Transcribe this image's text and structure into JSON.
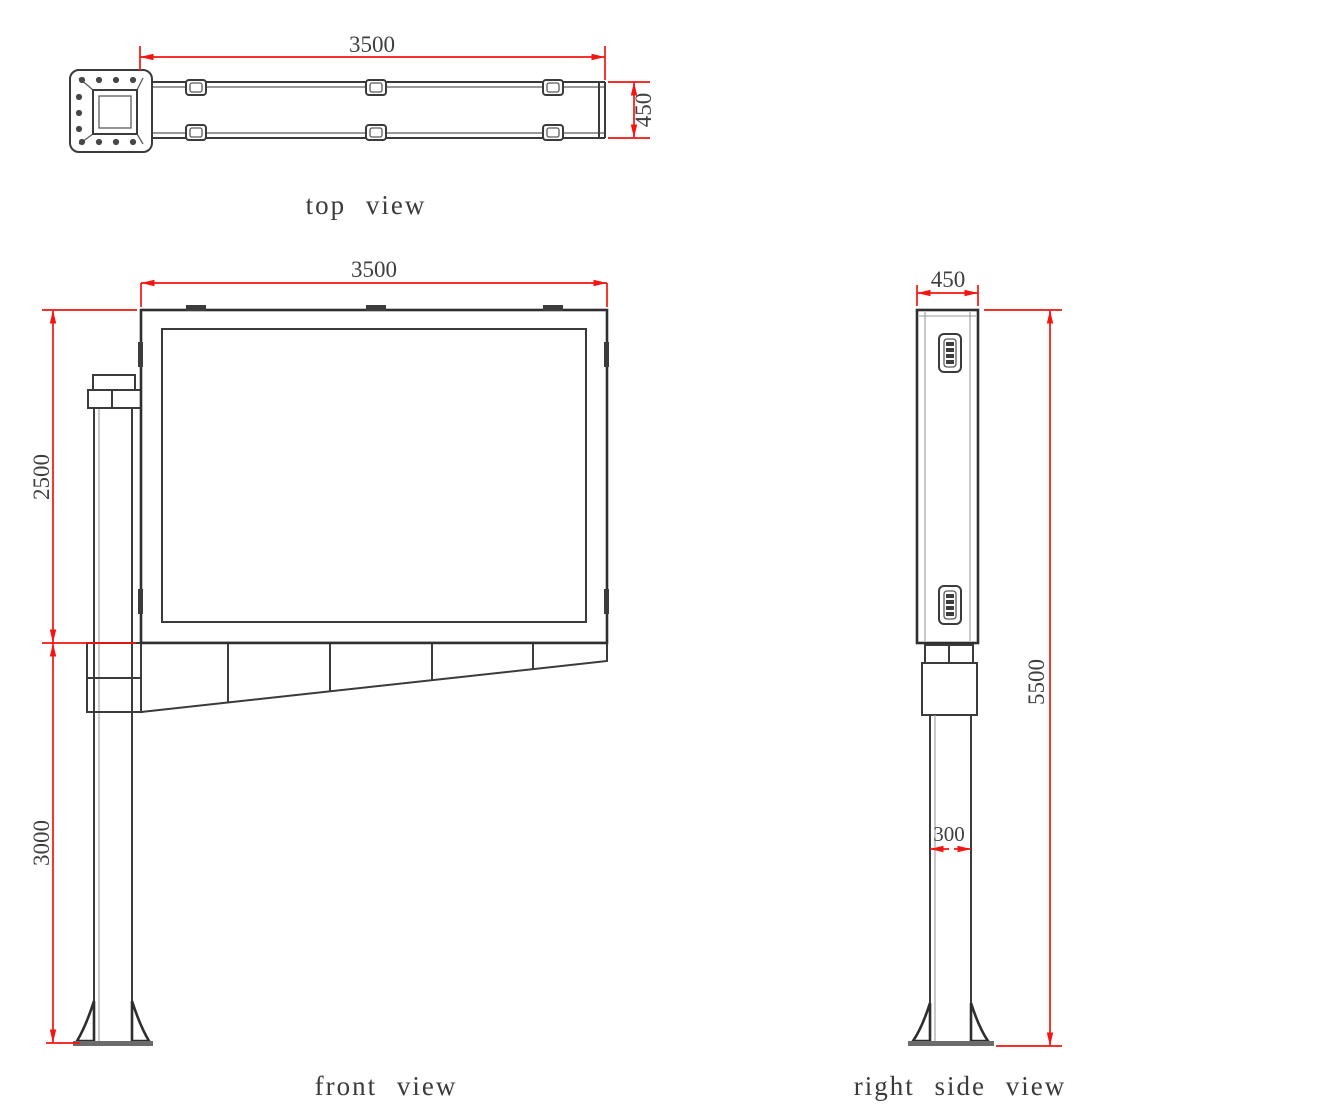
{
  "colors": {
    "dimension_color": "#f41410",
    "line_color": "#3b3b3b",
    "background": "#ffffff"
  },
  "views": {
    "top": {
      "label": "top view",
      "dimensions": {
        "width": "3500",
        "depth": "450"
      }
    },
    "front": {
      "label": "front view",
      "dimensions": {
        "width": "3500",
        "board_height": "2500",
        "pole_height": "3000"
      }
    },
    "side": {
      "label": "right side view",
      "dimensions": {
        "depth": "450",
        "total_height": "5500",
        "pole_width": "300"
      }
    }
  }
}
